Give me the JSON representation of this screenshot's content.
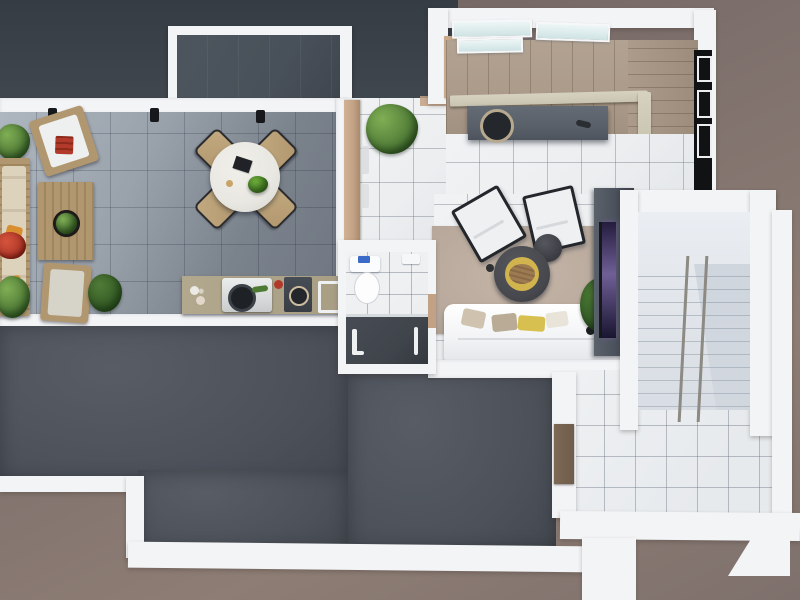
{
  "scene": {
    "kind": "top-down 3d floor plan render",
    "areas": [
      "terrace",
      "outdoor-kitchen",
      "dining-set",
      "entry-hall",
      "kitchen-with-stairs",
      "bathroom",
      "living-room",
      "stairwell-wing",
      "roof-deck",
      "outdoor-landing"
    ],
    "furniture": [
      "outdoor-sofa",
      "outdoor-armchair",
      "pallet-coffee-table",
      "round-dining-table",
      "dining-chair",
      "bbq-grill",
      "kitchen-island",
      "staircase",
      "toilet",
      "shower",
      "area-rug",
      "lounge-armchair",
      "round-coffee-table",
      "side-table",
      "white-sofa",
      "tv-cabinet",
      "potted-plant",
      "metal-handrail"
    ]
  },
  "colors": {
    "bg_dark": "#6b5f5d",
    "bg_mid": "#7e706c",
    "bg_light": "#8d7d74",
    "wall": "#f3f4f6",
    "roof_band_top": "#353c44",
    "roof_band_bottom": "#41474f",
    "court_interior": "#485059",
    "terrace_light": "#aeb6c0",
    "terrace_dark": "#6e7580",
    "roof_light": "#585d65",
    "roof": "#4c515a",
    "roof_dark": "#42474e",
    "int_tile": "#eceef0",
    "out_tile": "#e7eaed",
    "stair_wood": "#ac9b8a",
    "railing": "#c9c5b1",
    "skylight": "#cfe3e4",
    "island": "#596069",
    "island_dark": "#24282d",
    "wood_wall": "#c2a184",
    "pallet": "#b1976f",
    "cushion": "#ddd2bc",
    "leaf_light": "#7fae54",
    "leaf": "#55813a",
    "leaf_dark": "#2f5523",
    "red_accent": "#b23a2a",
    "orange_accent": "#d98f2f",
    "granite": "#b2a88e",
    "appliance_dark": "#393e45",
    "rug": "#b7a89b",
    "rug_light": "#c4b5a7",
    "sofa_white": "#f2f3f5",
    "pillow_beige": "#cfc3b0",
    "pillow_khaki": "#b9ab96",
    "pillow_yellow": "#d8c050",
    "chair_white": "#eef0f2",
    "chair_frame": "#23262b",
    "table_dark": "#47484e",
    "table_yellow": "#d2b44e",
    "table_wood_slice": "#9c7b52",
    "side_table": "#3a3c42",
    "tv_unit": "#4a515c",
    "tv_glow": "#6f5f96",
    "tv_screen": "#17181c",
    "stair_tread": "#e3e7ec",
    "stair_line": "#b4bcc5",
    "rail_metal": "#8d8983",
    "shower_dark": "#40454c",
    "door_brown": "#6f5c4a",
    "dining_chair": "#b3986f",
    "dining_table_top": "#e9e7e2",
    "toilet_blue": "#3a6bc9"
  }
}
